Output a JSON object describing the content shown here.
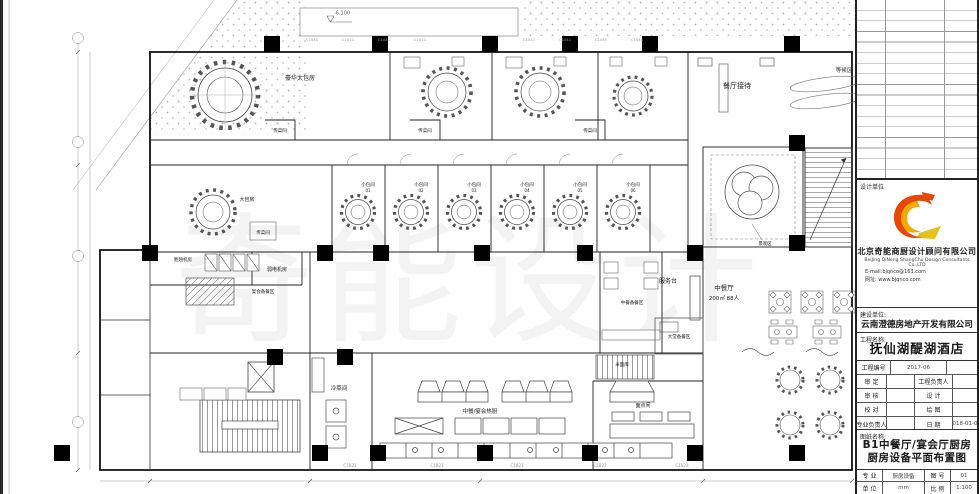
{
  "sheet": {
    "watermark": "奇能设计"
  },
  "plan": {
    "elevation_note": "-6.100",
    "tags": {
      "window_top": "C1041",
      "window_bottom": "C1B23"
    },
    "rooms": {
      "luxury_private": "豪华大包房",
      "reception": "餐厅接待",
      "waiting": "等候区",
      "serving": "传菜间",
      "big_private": "大包房",
      "small_private": {
        "label": "小包间",
        "numbers": [
          "01",
          "02",
          "03",
          "04",
          "05",
          "06"
        ]
      },
      "weak_current": "弱电机房",
      "baochi": "鲍翅机房",
      "banquet_prep": "宴会备餐区",
      "service_desk": "服务台",
      "restaurant": "中餐厅",
      "restaurant_cap": "200㎡ 88人",
      "chinese_prep": "中餐备餐区",
      "lobby_prep": "大堂备餐区",
      "landscape": "景观区",
      "hot_kitchen": "中餐/宴会热厨",
      "cold_dish": "冷菜间",
      "pastry": "面点间",
      "rice_flour": "米面库"
    }
  },
  "titleblock": {
    "design_unit_label": "设计单位",
    "company_cn": "北京奇能商厨设计顾问有限公司",
    "company_en": "BeiJing QiNeng ShangChu Design Consultants Co.,LTD",
    "email": "E-mail:bjqnco@163.com",
    "website": "网址: www.bjqnco.com",
    "client_label": "建设单位:",
    "client": "云南澄德房地产开发有限公司",
    "project_label": "工程名称:",
    "project": "抚仙湖醍湖酒店",
    "project_no_label": "工程编号",
    "project_no": "2017-06",
    "rows": [
      {
        "l": "审 定",
        "r": "工程负责人",
        "rv": ""
      },
      {
        "l": "审 核",
        "r": "设 计",
        "rv": ""
      },
      {
        "l": "校 对",
        "r": "绘 图",
        "rv": ""
      },
      {
        "l": "专业负责人",
        "r": "日 期",
        "rv": "2018-01-06"
      }
    ],
    "drawing_label": "图纸名称:",
    "drawing_line1": "B1中餐厅/宴会厅厨房",
    "drawing_line2": "厨房设备平面布置图",
    "specialty_label": "专 业",
    "specialty": "厨房设备",
    "sheet_no_label": "图 号",
    "sheet_no": "01",
    "unit_label": "单 位",
    "unit": "mm",
    "scale_label": "比 例",
    "scale": "1:100"
  },
  "colors": {
    "logo_red": "#E8470B",
    "logo_yellow": "#F5A800",
    "line": "#1a1a1a"
  }
}
